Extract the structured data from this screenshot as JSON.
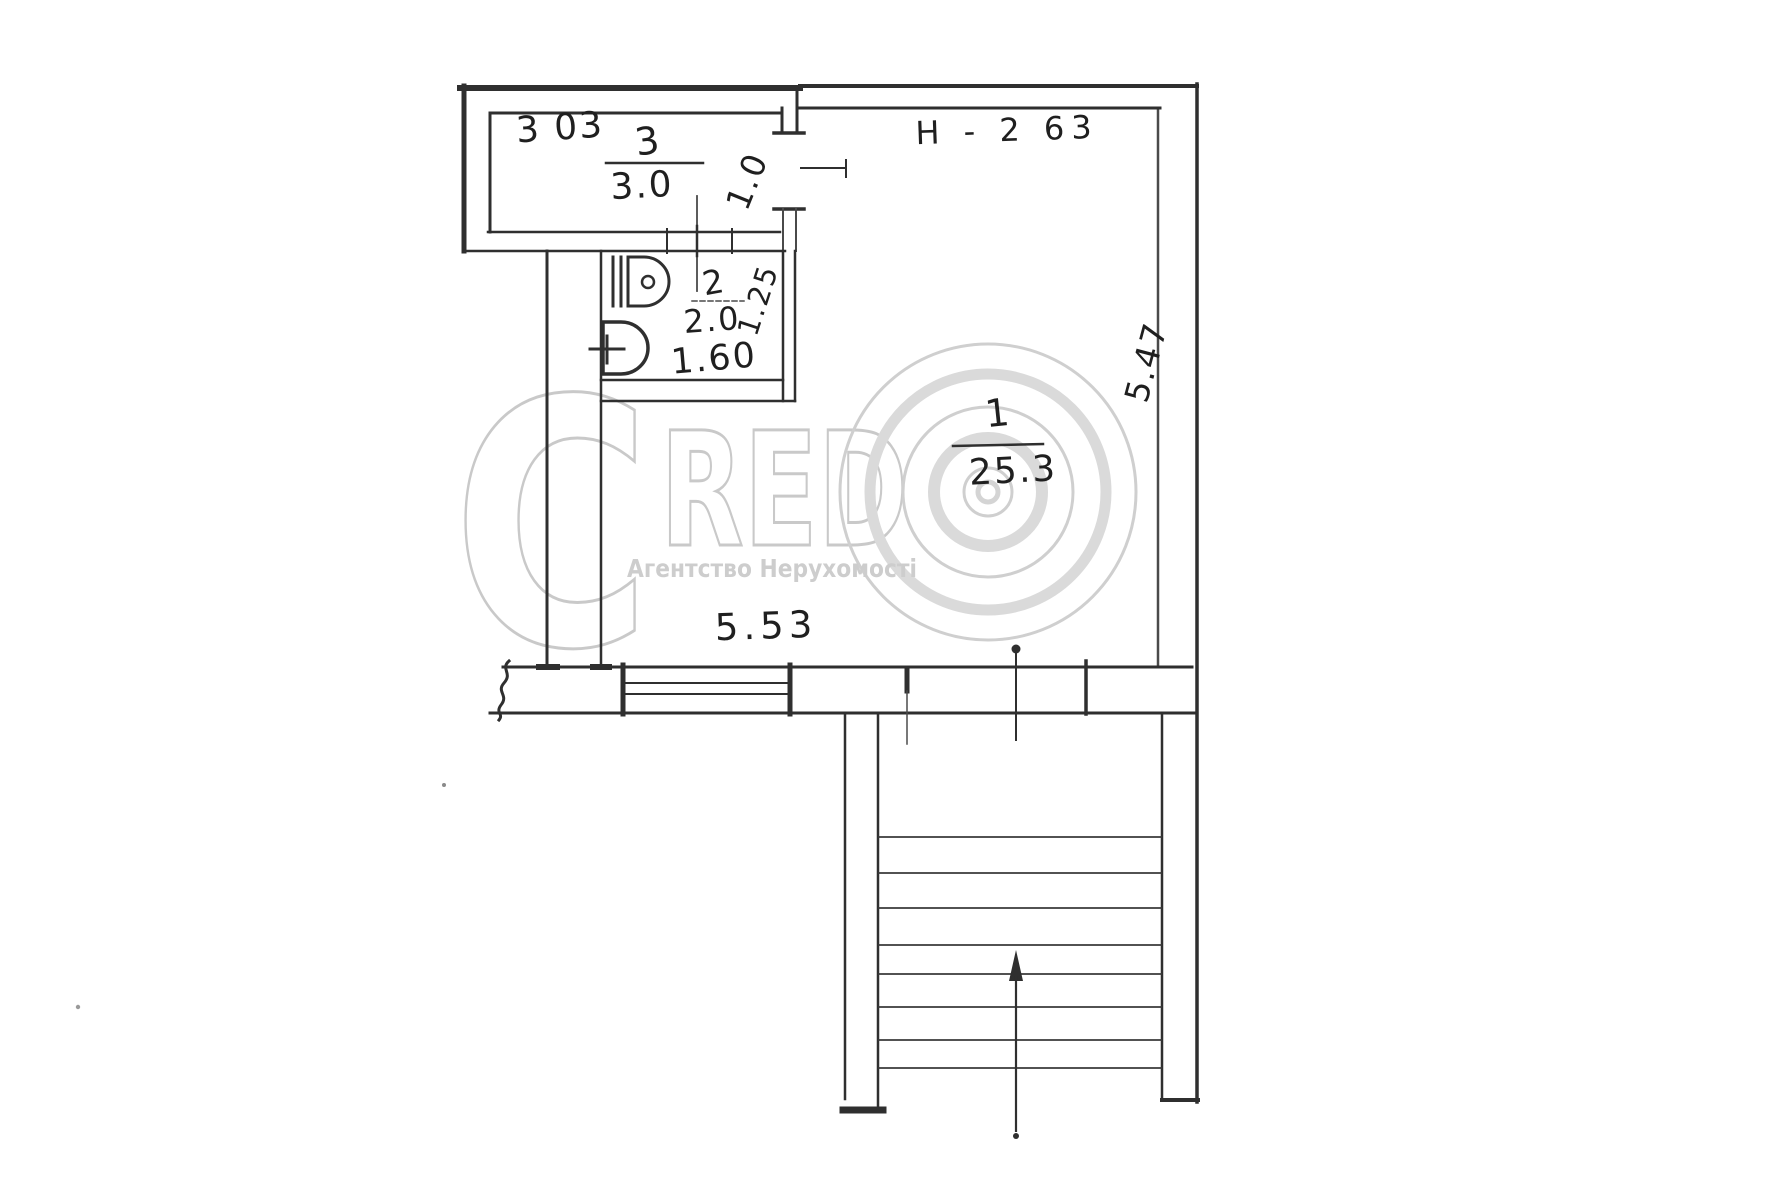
{
  "labels": {
    "room3_width": "3 03",
    "room3_number": "3",
    "room3_area": "3.0",
    "door_width": "1.0",
    "ceiling_height": "Н - 2 63",
    "room2_number": "2",
    "room2_area": "2.0",
    "bath_width": "1.25",
    "bath_length": "1.60",
    "room1_number": "1",
    "room1_area": "25.3",
    "overall_width": "5.53",
    "overall_depth": "5.47"
  },
  "watermark": {
    "letter_c": "C",
    "letters_red": "RED",
    "agency": "Агентство Нерухомості"
  },
  "colors": {
    "ink": "#2f2f2f",
    "ink_light": "#4a4a4a",
    "watermark_grey": "#c9c9c9",
    "background": "#ffffff"
  }
}
